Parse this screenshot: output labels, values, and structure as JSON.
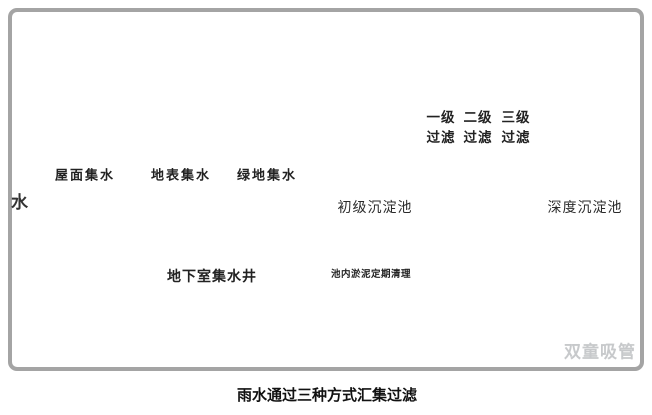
{
  "panel": {
    "left_partial_label": "水",
    "ground_labels": {
      "roof": "屋面集水",
      "surface": "地表集水",
      "green": "绿地集水"
    },
    "basement": {
      "well_label": "地下室集水井"
    },
    "tanks": {
      "primary": "初级沉淀池",
      "deep": "深度沉淀池",
      "sludge_note": "池内淤泥定期清理"
    },
    "filters": {
      "stages": [
        {
          "line1": "一级",
          "line2": "过滤"
        },
        {
          "line1": "二级",
          "line2": "过滤"
        },
        {
          "line1": "三级",
          "line2": "过滤"
        }
      ]
    },
    "watermark": "双童吸管"
  },
  "caption": "雨水通过三种方式汇集过滤",
  "icons": {
    "trees": "tree-icon",
    "sludge_arrow": "down-arrow-icon",
    "flow_arrow": "up-arrow-icon",
    "well_pointer": "arrow-icon",
    "watermark_logo": "panda-face-icon"
  },
  "colors": {
    "line_blue": "#3E9BD6",
    "filter_fill": "#2E7FC2",
    "well_water": "#C8E6F5",
    "ground_grey": "#CBCBCB",
    "frame_grey": "#A4A4A4",
    "dark_arrow": "#555555",
    "watermark_grey": "#C7C9CB"
  }
}
